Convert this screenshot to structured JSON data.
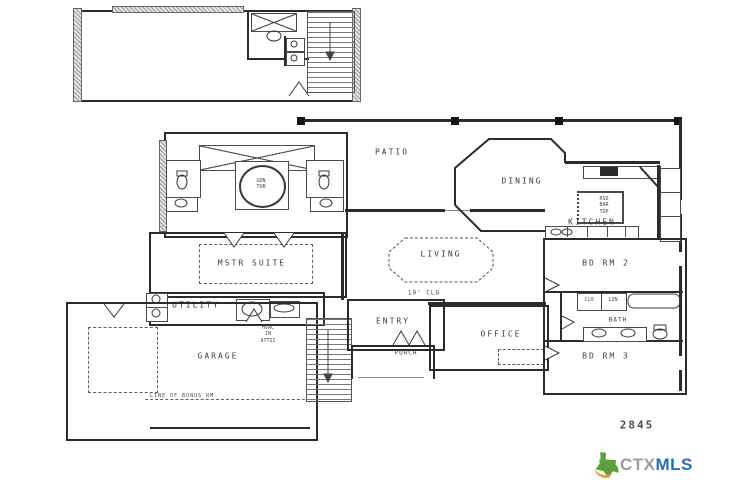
{
  "plan": {
    "number": "2845",
    "rooms": {
      "patio": "PATIO",
      "dining": "DINING",
      "kitchen": "KITCHEN",
      "mstr_suite": "MSTR SUITE",
      "living": "LIVING",
      "living_ceiling": "10' CLG",
      "utility": "UTILITY",
      "entry": "ENTRY",
      "porch": "PORCH",
      "office": "OFFICE",
      "garage": "GARAGE",
      "bd_rm_2": "BD RM 2",
      "bath": "BATH",
      "bd_rm_3": "BD RM 3"
    },
    "notes": {
      "hvac": [
        "HVAC",
        "IN",
        "ATTIC"
      ],
      "bonus_line": "LINE OF BONUS RM",
      "island": [
        "RSD",
        "BAR",
        "TOP"
      ],
      "tub": [
        "GDN",
        "TUB"
      ],
      "closet": "CLO",
      "linen": "LIN"
    }
  },
  "watermark": {
    "ctx": "CTX",
    "mls": "MLS",
    "colors": {
      "ctx": "#999da1",
      "mls": "#2a6db5",
      "texas": "#5d9e3d",
      "swoosh": "#e9a23b"
    }
  }
}
